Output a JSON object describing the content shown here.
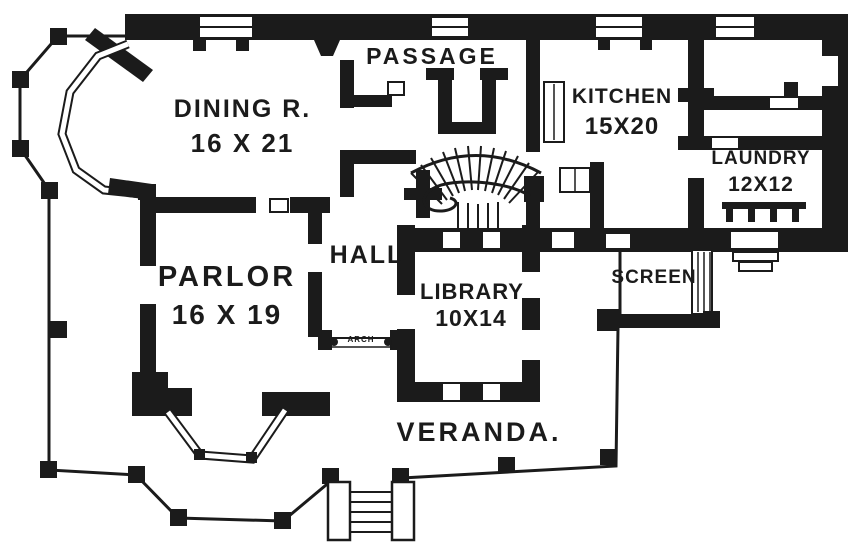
{
  "figure": {
    "type": "house-first-floor-plan",
    "ink": "#1b1b1b",
    "paper": "#ffffff"
  },
  "rooms": [
    {
      "id": "passage",
      "name": "PASSAGE",
      "dims": ""
    },
    {
      "id": "dining",
      "name": "DINING R.",
      "dims": "16 X 21"
    },
    {
      "id": "kitchen",
      "name": "KITCHEN",
      "dims": "15X20"
    },
    {
      "id": "laundry",
      "name": "LAUNDRY",
      "dims": "12X12"
    },
    {
      "id": "hall",
      "name": "HALL",
      "dims": ""
    },
    {
      "id": "parlor",
      "name": "PARLOR",
      "dims": "16 X 19"
    },
    {
      "id": "library",
      "name": "LIBRARY",
      "dims": "10X14"
    },
    {
      "id": "screen",
      "name": "SCREEN",
      "dims": ""
    },
    {
      "id": "arch",
      "name": "ARCH",
      "dims": ""
    },
    {
      "id": "veranda",
      "name": "VERANDA.",
      "dims": ""
    }
  ]
}
